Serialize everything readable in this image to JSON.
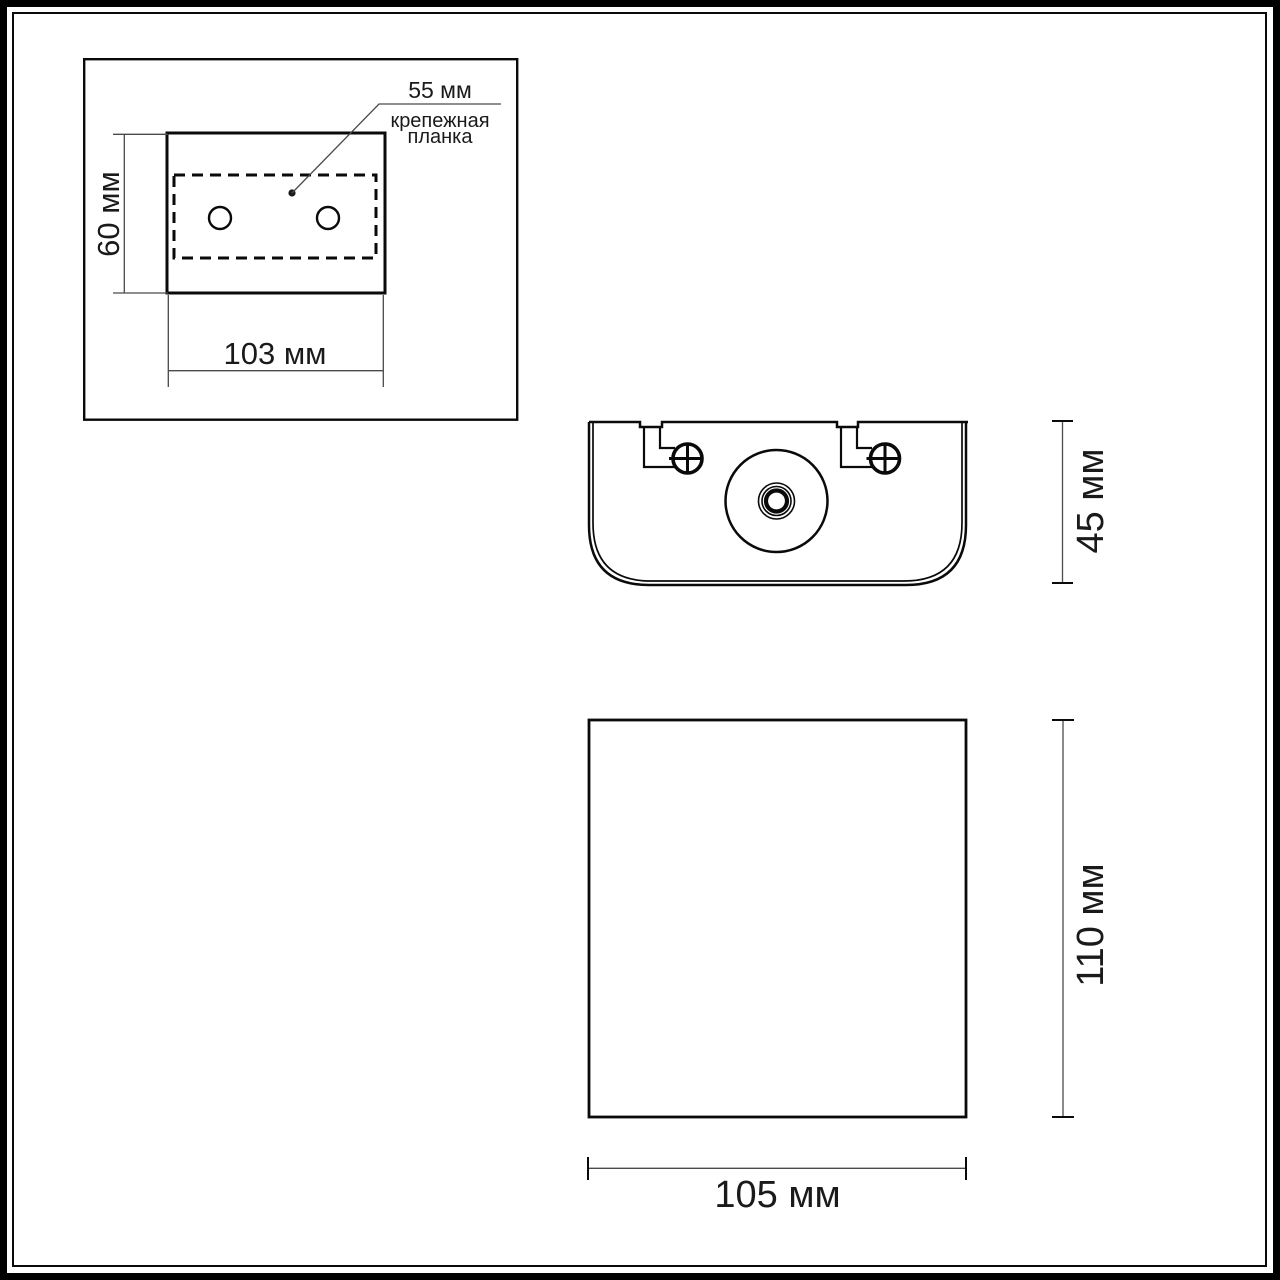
{
  "drawing": {
    "type": "technical-dimension-drawing",
    "detail_view": {
      "plate_offset_dim": "55 мм",
      "plate_label_line1": "крепежная",
      "plate_label_line2": "планка",
      "height_dim": "60 мм",
      "width_dim": "103 мм"
    },
    "top_view": {
      "depth_dim": "45 мм"
    },
    "front_view": {
      "height_dim": "110 мм",
      "width_dim": "105 мм"
    },
    "colors": {
      "background": "#ffffff",
      "object_line": "#0a0a0a",
      "dimension_line": "#4a4a4a",
      "text": "#1a1a1a"
    }
  }
}
